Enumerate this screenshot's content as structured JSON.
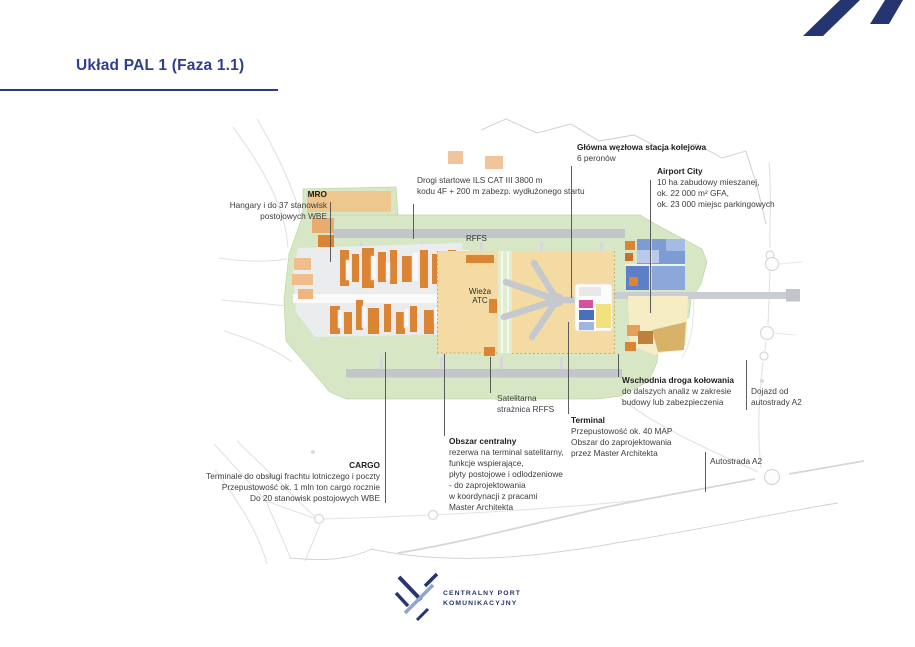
{
  "slide": {
    "title": "Układ PAL 1 (Faza 1.1)"
  },
  "branding": {
    "footer_line1": "CENTRALNY PORT",
    "footer_line2": "KOMUNIKACYJNY"
  },
  "map_labels": {
    "rffs": "RFFS",
    "atc_line1": "Wieża",
    "atc_line2": "ATC"
  },
  "annotations": {
    "mro": {
      "title": "MRO",
      "lines": [
        "Hangary i do 37 stanowisk",
        "postojowych WBE"
      ]
    },
    "runways": {
      "lines": [
        "Drogi startowe ILS CAT III 3800 m",
        "kodu 4F + 200 m zabezp. wydłużonego startu"
      ]
    },
    "rail_station": {
      "title": "Główna węzłowa stacja kolejowa",
      "lines": [
        "6 peronów"
      ]
    },
    "airport_city": {
      "title": "Airport City",
      "lines": [
        "10 ha zabudowy mieszanej,",
        "ok. 22 000 m² GFA,",
        "ok. 23 000 miejsc parkingowych"
      ]
    },
    "satellite_rffs": {
      "lines": [
        "Satelitarna",
        "strażnica RFFS"
      ]
    },
    "east_taxiway": {
      "title": "Wschodnia droga kołowania",
      "lines": [
        "do dalszych analiz w zakresie",
        "budowy lub zabezpieczenia"
      ]
    },
    "a2_access": {
      "lines": [
        "Dojazd od",
        "autostrady A2"
      ]
    },
    "terminal": {
      "title": "Terminal",
      "lines": [
        "Przepustowość ok. 40 MAP",
        "Obszar do zaprojektowania",
        "przez Master Architekta"
      ]
    },
    "central_area": {
      "title": "Obszar centralny",
      "lines": [
        "rezerwa na terminal satelitarny,",
        "funkcje wspierające,",
        "płyty postojowe i odlodzeniowe",
        "- do zaprojektowania",
        "w koordynacji z pracami",
        "Master Architekta"
      ]
    },
    "cargo": {
      "title": "CARGO",
      "lines": [
        "Terminale do obsługi frachtu lotniczego i poczty",
        "Przepustowość ok. 1 mln ton cargo rocznie",
        "Do 20 stanowisk postojowych WBE"
      ]
    },
    "a2_highway": {
      "label": "Autostrada A2"
    }
  },
  "colors": {
    "accent_blue": "#303E90",
    "logo_navy": "#24356F",
    "logo_light_blue": "#8FA6CE",
    "map_green": "#D7E7C5",
    "apron_tan": "#F3DBA3",
    "building_orange": "#DB8434",
    "runway_gray": "#C2C6CB",
    "airport_city_blue": "#7E9CD4",
    "terminal_pink": "#D8519C",
    "terminal_blue": "#4C6FBD",
    "terminal_yellow": "#F3E07F"
  }
}
